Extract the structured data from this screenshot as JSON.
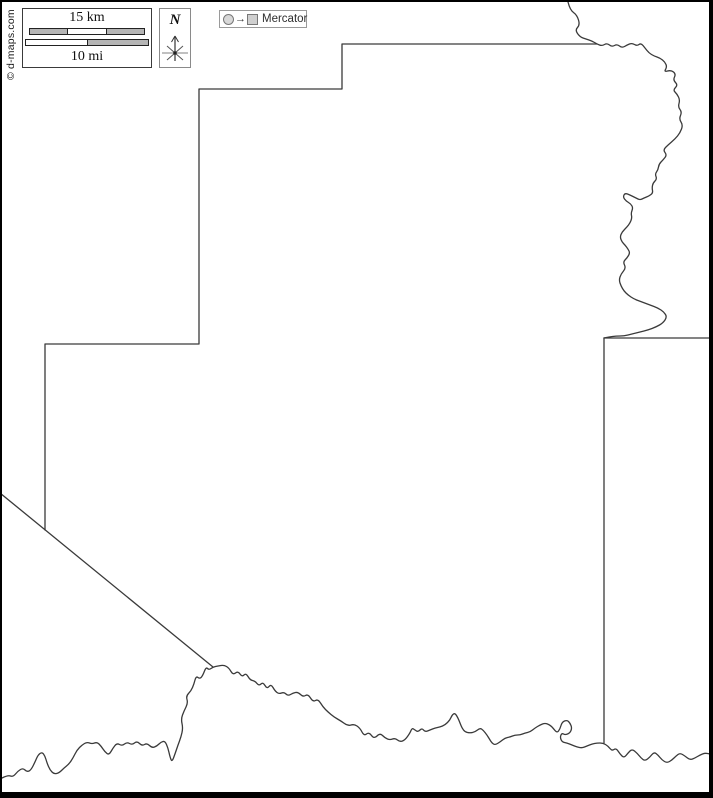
{
  "copyright": {
    "text": "© d-maps.com"
  },
  "scale_box": {
    "km_label": "15 km",
    "mi_label": "10 mi"
  },
  "compass": {
    "north_label": "N"
  },
  "projection_legend": {
    "arrow": "→",
    "label": "Mercator"
  },
  "map": {
    "background": "#ffffff",
    "stroke_color": "#3a3a3a",
    "frame_color": "#000000",
    "paths": [
      {
        "name": "north-step-boundary",
        "smooth": false,
        "points": [
          [
            597,
            44
          ],
          [
            342,
            44
          ],
          [
            342,
            89
          ],
          [
            199,
            89
          ],
          [
            199,
            344
          ],
          [
            45,
            344
          ],
          [
            45,
            530
          ]
        ]
      },
      {
        "name": "southwest-diagonal-boundary",
        "smooth": false,
        "points": [
          [
            0,
            493
          ],
          [
            213,
            667
          ]
        ]
      },
      {
        "name": "east-boundary-line",
        "smooth": false,
        "points": [
          [
            604,
            338
          ],
          [
            604,
            743
          ]
        ]
      },
      {
        "name": "northeast-neighbor-line",
        "smooth": false,
        "points": [
          [
            604,
            338
          ],
          [
            710,
            338
          ]
        ]
      },
      {
        "name": "northeast-river-boundary",
        "smooth": true,
        "points": [
          [
            568,
            2
          ],
          [
            570,
            10
          ],
          [
            577,
            15
          ],
          [
            580,
            25
          ],
          [
            575,
            30
          ],
          [
            580,
            37
          ],
          [
            586,
            39
          ],
          [
            592,
            41
          ],
          [
            597,
            44
          ],
          [
            602,
            46
          ],
          [
            607,
            43
          ],
          [
            612,
            47
          ],
          [
            617,
            44
          ],
          [
            622,
            48
          ],
          [
            627,
            45
          ],
          [
            632,
            43
          ],
          [
            637,
            46
          ],
          [
            641,
            43
          ],
          [
            645,
            48
          ],
          [
            649,
            53
          ],
          [
            654,
            56
          ],
          [
            660,
            58
          ],
          [
            665,
            62
          ],
          [
            667,
            67
          ],
          [
            664,
            72
          ],
          [
            671,
            70
          ],
          [
            676,
            74
          ],
          [
            673,
            80
          ],
          [
            678,
            85
          ],
          [
            673,
            90
          ],
          [
            677,
            94
          ],
          [
            680,
            100
          ],
          [
            678,
            107
          ],
          [
            682,
            112
          ],
          [
            679,
            119
          ],
          [
            683,
            125
          ],
          [
            680,
            133
          ],
          [
            675,
            139
          ],
          [
            668,
            145
          ],
          [
            663,
            150
          ],
          [
            667,
            155
          ],
          [
            663,
            160
          ],
          [
            659,
            164
          ],
          [
            658,
            170
          ],
          [
            655,
            174
          ],
          [
            657,
            179
          ],
          [
            653,
            183
          ],
          [
            652,
            188
          ],
          [
            653,
            193
          ],
          [
            649,
            196
          ],
          [
            644,
            198
          ],
          [
            640,
            200
          ],
          [
            636,
            198
          ],
          [
            630,
            195
          ],
          [
            625,
            193
          ],
          [
            623,
            197
          ],
          [
            626,
            201
          ],
          [
            631,
            204
          ],
          [
            633,
            208
          ],
          [
            631,
            213
          ],
          [
            632,
            218
          ],
          [
            630,
            223
          ],
          [
            627,
            227
          ],
          [
            622,
            232
          ],
          [
            620,
            237
          ],
          [
            622,
            242
          ],
          [
            625,
            245
          ],
          [
            628,
            249
          ],
          [
            630,
            253
          ],
          [
            627,
            258
          ],
          [
            623,
            262
          ],
          [
            626,
            268
          ],
          [
            621,
            274
          ],
          [
            619,
            280
          ],
          [
            621,
            286
          ],
          [
            624,
            291
          ],
          [
            628,
            295
          ],
          [
            634,
            299
          ],
          [
            642,
            302
          ],
          [
            650,
            305
          ],
          [
            658,
            308
          ],
          [
            664,
            312
          ],
          [
            667,
            317
          ],
          [
            663,
            323
          ],
          [
            656,
            327
          ],
          [
            648,
            330
          ],
          [
            640,
            332
          ],
          [
            632,
            334
          ],
          [
            624,
            336
          ],
          [
            616,
            336
          ],
          [
            609,
            337
          ],
          [
            604,
            338
          ]
        ]
      },
      {
        "name": "south-river-boundary",
        "smooth": true,
        "points": [
          [
            2,
            778
          ],
          [
            8,
            775
          ],
          [
            13,
            777
          ],
          [
            18,
            771
          ],
          [
            23,
            768
          ],
          [
            27,
            772
          ],
          [
            31,
            770
          ],
          [
            35,
            762
          ],
          [
            38,
            755
          ],
          [
            42,
            752
          ],
          [
            45,
            756
          ],
          [
            47,
            763
          ],
          [
            50,
            770
          ],
          [
            54,
            774
          ],
          [
            59,
            773
          ],
          [
            64,
            768
          ],
          [
            69,
            764
          ],
          [
            73,
            758
          ],
          [
            77,
            750
          ],
          [
            82,
            745
          ],
          [
            87,
            742
          ],
          [
            92,
            744
          ],
          [
            97,
            742
          ],
          [
            101,
            746
          ],
          [
            105,
            752
          ],
          [
            109,
            755
          ],
          [
            113,
            748
          ],
          [
            117,
            743
          ],
          [
            122,
            746
          ],
          [
            127,
            742
          ],
          [
            132,
            745
          ],
          [
            137,
            741
          ],
          [
            142,
            746
          ],
          [
            147,
            743
          ],
          [
            152,
            748
          ],
          [
            157,
            746
          ],
          [
            161,
            742
          ],
          [
            165,
            741
          ],
          [
            168,
            748
          ],
          [
            170,
            757
          ],
          [
            172,
            762
          ],
          [
            175,
            754
          ],
          [
            178,
            745
          ],
          [
            181,
            737
          ],
          [
            183,
            728
          ],
          [
            181,
            719
          ],
          [
            184,
            711
          ],
          [
            188,
            703
          ],
          [
            186,
            696
          ],
          [
            191,
            691
          ],
          [
            194,
            684
          ],
          [
            196,
            676
          ],
          [
            200,
            679
          ],
          [
            203,
            675
          ],
          [
            206,
            667
          ],
          [
            209,
            670
          ],
          [
            213,
            667
          ],
          [
            218,
            666
          ],
          [
            224,
            665
          ],
          [
            229,
            668
          ],
          [
            233,
            675
          ],
          [
            238,
            671
          ],
          [
            242,
            677
          ],
          [
            246,
            673
          ],
          [
            250,
            680
          ],
          [
            255,
            681
          ],
          [
            259,
            686
          ],
          [
            263,
            682
          ],
          [
            267,
            689
          ],
          [
            271,
            684
          ],
          [
            275,
            691
          ],
          [
            279,
            694
          ],
          [
            284,
            692
          ],
          [
            288,
            696
          ],
          [
            293,
            693
          ],
          [
            298,
            692
          ],
          [
            303,
            697
          ],
          [
            308,
            694
          ],
          [
            313,
            702
          ],
          [
            318,
            699
          ],
          [
            323,
            707
          ],
          [
            328,
            712
          ],
          [
            334,
            717
          ],
          [
            341,
            721
          ],
          [
            348,
            726
          ],
          [
            354,
            724
          ],
          [
            360,
            728
          ],
          [
            364,
            736
          ],
          [
            369,
            732
          ],
          [
            374,
            739
          ],
          [
            380,
            733
          ],
          [
            385,
            738
          ],
          [
            390,
            740
          ],
          [
            395,
            738
          ],
          [
            400,
            742
          ],
          [
            405,
            740
          ],
          [
            410,
            733
          ],
          [
            412,
            728
          ],
          [
            415,
            730
          ],
          [
            418,
            732
          ],
          [
            422,
            728
          ],
          [
            425,
            732
          ],
          [
            430,
            730
          ],
          [
            435,
            728
          ],
          [
            440,
            727
          ],
          [
            445,
            725
          ],
          [
            450,
            720
          ],
          [
            452,
            715
          ],
          [
            455,
            713
          ],
          [
            458,
            718
          ],
          [
            460,
            723
          ],
          [
            462,
            728
          ],
          [
            465,
            732
          ],
          [
            470,
            733
          ],
          [
            475,
            732
          ],
          [
            480,
            728
          ],
          [
            483,
            730
          ],
          [
            487,
            735
          ],
          [
            490,
            740
          ],
          [
            492,
            743
          ],
          [
            495,
            745
          ],
          [
            500,
            742
          ],
          [
            505,
            738
          ],
          [
            510,
            737
          ],
          [
            515,
            735
          ],
          [
            520,
            735
          ],
          [
            525,
            733
          ],
          [
            530,
            732
          ],
          [
            535,
            728
          ],
          [
            540,
            725
          ],
          [
            545,
            723
          ],
          [
            550,
            725
          ],
          [
            553,
            728
          ],
          [
            557,
            733
          ],
          [
            560,
            729
          ],
          [
            562,
            722
          ],
          [
            567,
            720
          ],
          [
            570,
            723
          ],
          [
            572,
            728
          ],
          [
            570,
            733
          ],
          [
            565,
            735
          ],
          [
            562,
            733
          ],
          [
            560,
            737
          ],
          [
            562,
            742
          ],
          [
            567,
            743
          ],
          [
            572,
            745
          ],
          [
            577,
            747
          ],
          [
            582,
            748
          ],
          [
            587,
            746
          ],
          [
            592,
            744
          ],
          [
            597,
            743
          ],
          [
            603,
            743
          ],
          [
            608,
            746
          ],
          [
            612,
            751
          ],
          [
            616,
            748
          ],
          [
            620,
            754
          ],
          [
            624,
            758
          ],
          [
            628,
            753
          ],
          [
            632,
            749
          ],
          [
            637,
            753
          ],
          [
            641,
            758
          ],
          [
            645,
            761
          ],
          [
            650,
            757
          ],
          [
            654,
            752
          ],
          [
            658,
            755
          ],
          [
            662,
            760
          ],
          [
            667,
            763
          ],
          [
            672,
            760
          ],
          [
            676,
            756
          ],
          [
            680,
            753
          ],
          [
            685,
            756
          ],
          [
            690,
            760
          ],
          [
            695,
            758
          ],
          [
            700,
            755
          ],
          [
            705,
            753
          ],
          [
            710,
            754
          ]
        ]
      }
    ]
  }
}
